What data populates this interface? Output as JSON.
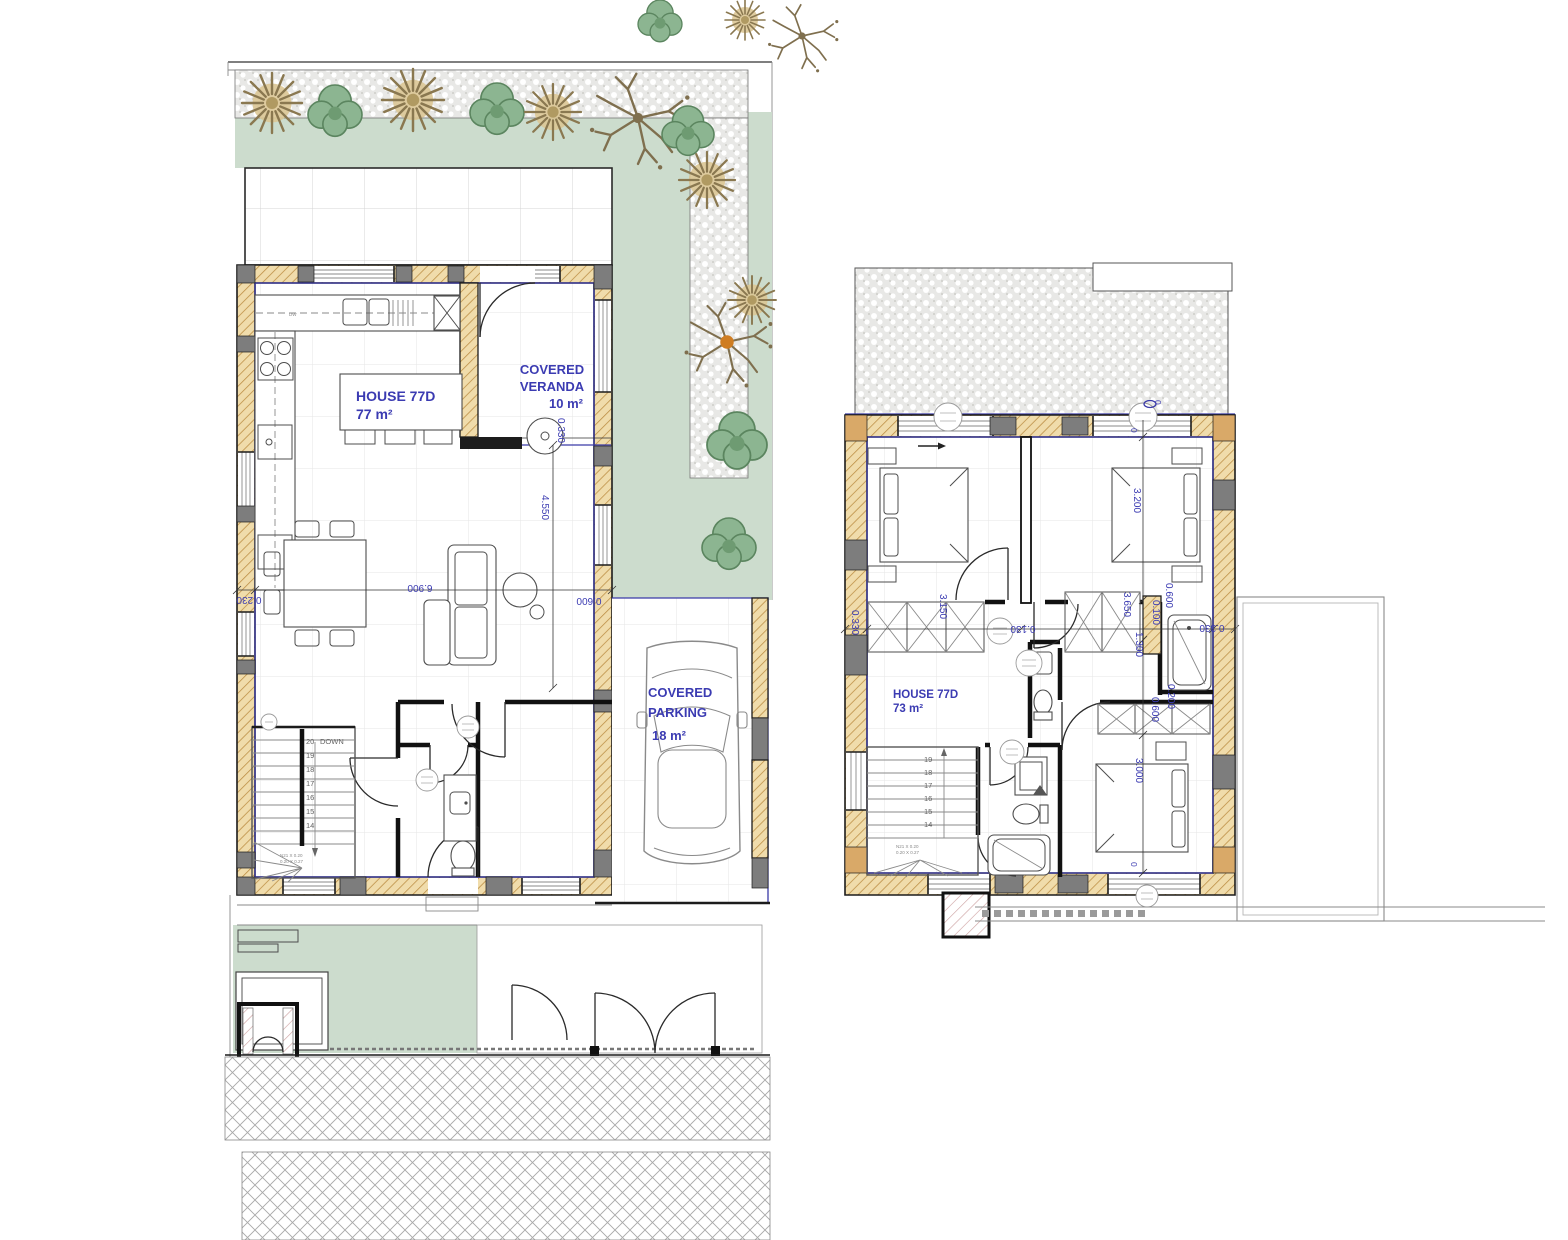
{
  "ground_floor_plan": {
    "house_label_line1": "HOUSE 77D",
    "house_label_line2": "77 m²",
    "veranda_label_line1": "COVERED",
    "veranda_label_line2": "VERANDA",
    "veranda_label_line3": "10 m²",
    "parking_label_line1": "COVERED",
    "parking_label_line2": "PARKING",
    "parking_label_line3": "18 m²",
    "kitchen_dishwasher_label": "DW",
    "stairs": {
      "direction_label": "DOWN",
      "numbers": [
        "20",
        "19",
        "18",
        "17",
        "16",
        "15",
        "14"
      ],
      "note_line1": "N21 X 0.20",
      "note_line2": "0.20 X 0.27"
    },
    "dimensions": {
      "interior_width": "6.900",
      "living_depth": "4.550",
      "wall_thickness": "0.230",
      "veranda_offset": "0.330",
      "parking_offset": "0.600"
    }
  },
  "first_floor_plan": {
    "house_label_line1": "HOUSE 77D",
    "house_label_line2": "73 m²",
    "stairs": {
      "numbers": [
        "19",
        "18",
        "17",
        "16",
        "15",
        "14"
      ],
      "note_line1": "N21 X 0.20",
      "note_line2": "0.20 X 0.27"
    },
    "dimensions": {
      "bedroom1_width": "3.150",
      "bedroom2_depth": "3.200",
      "bedroom3_depth": "3.000",
      "landing_width": "3.650",
      "hall_depth": "1.300",
      "wardrobe_depth": "0.600",
      "wardrobe2_depth": "0.600",
      "partition_a": "0.100",
      "partition_b": "0.200",
      "door_offset": "0.130",
      "wall_left": "0.330",
      "wall_right": "0.330",
      "level_mark_1": "0",
      "level_mark_2": "0",
      "level_mark_3": "0"
    }
  },
  "colors": {
    "annotation_blue": "#3b3bb2",
    "boundary_navy": "#3a3aa8",
    "wall_fill": "#f0dcab",
    "wall_hatch": "#bb8c42",
    "concrete_gray": "#7d7d7d",
    "lawn_green": "#ccdccd",
    "bush_green": "#8cb591",
    "shrub_tan": "#dcc795"
  }
}
